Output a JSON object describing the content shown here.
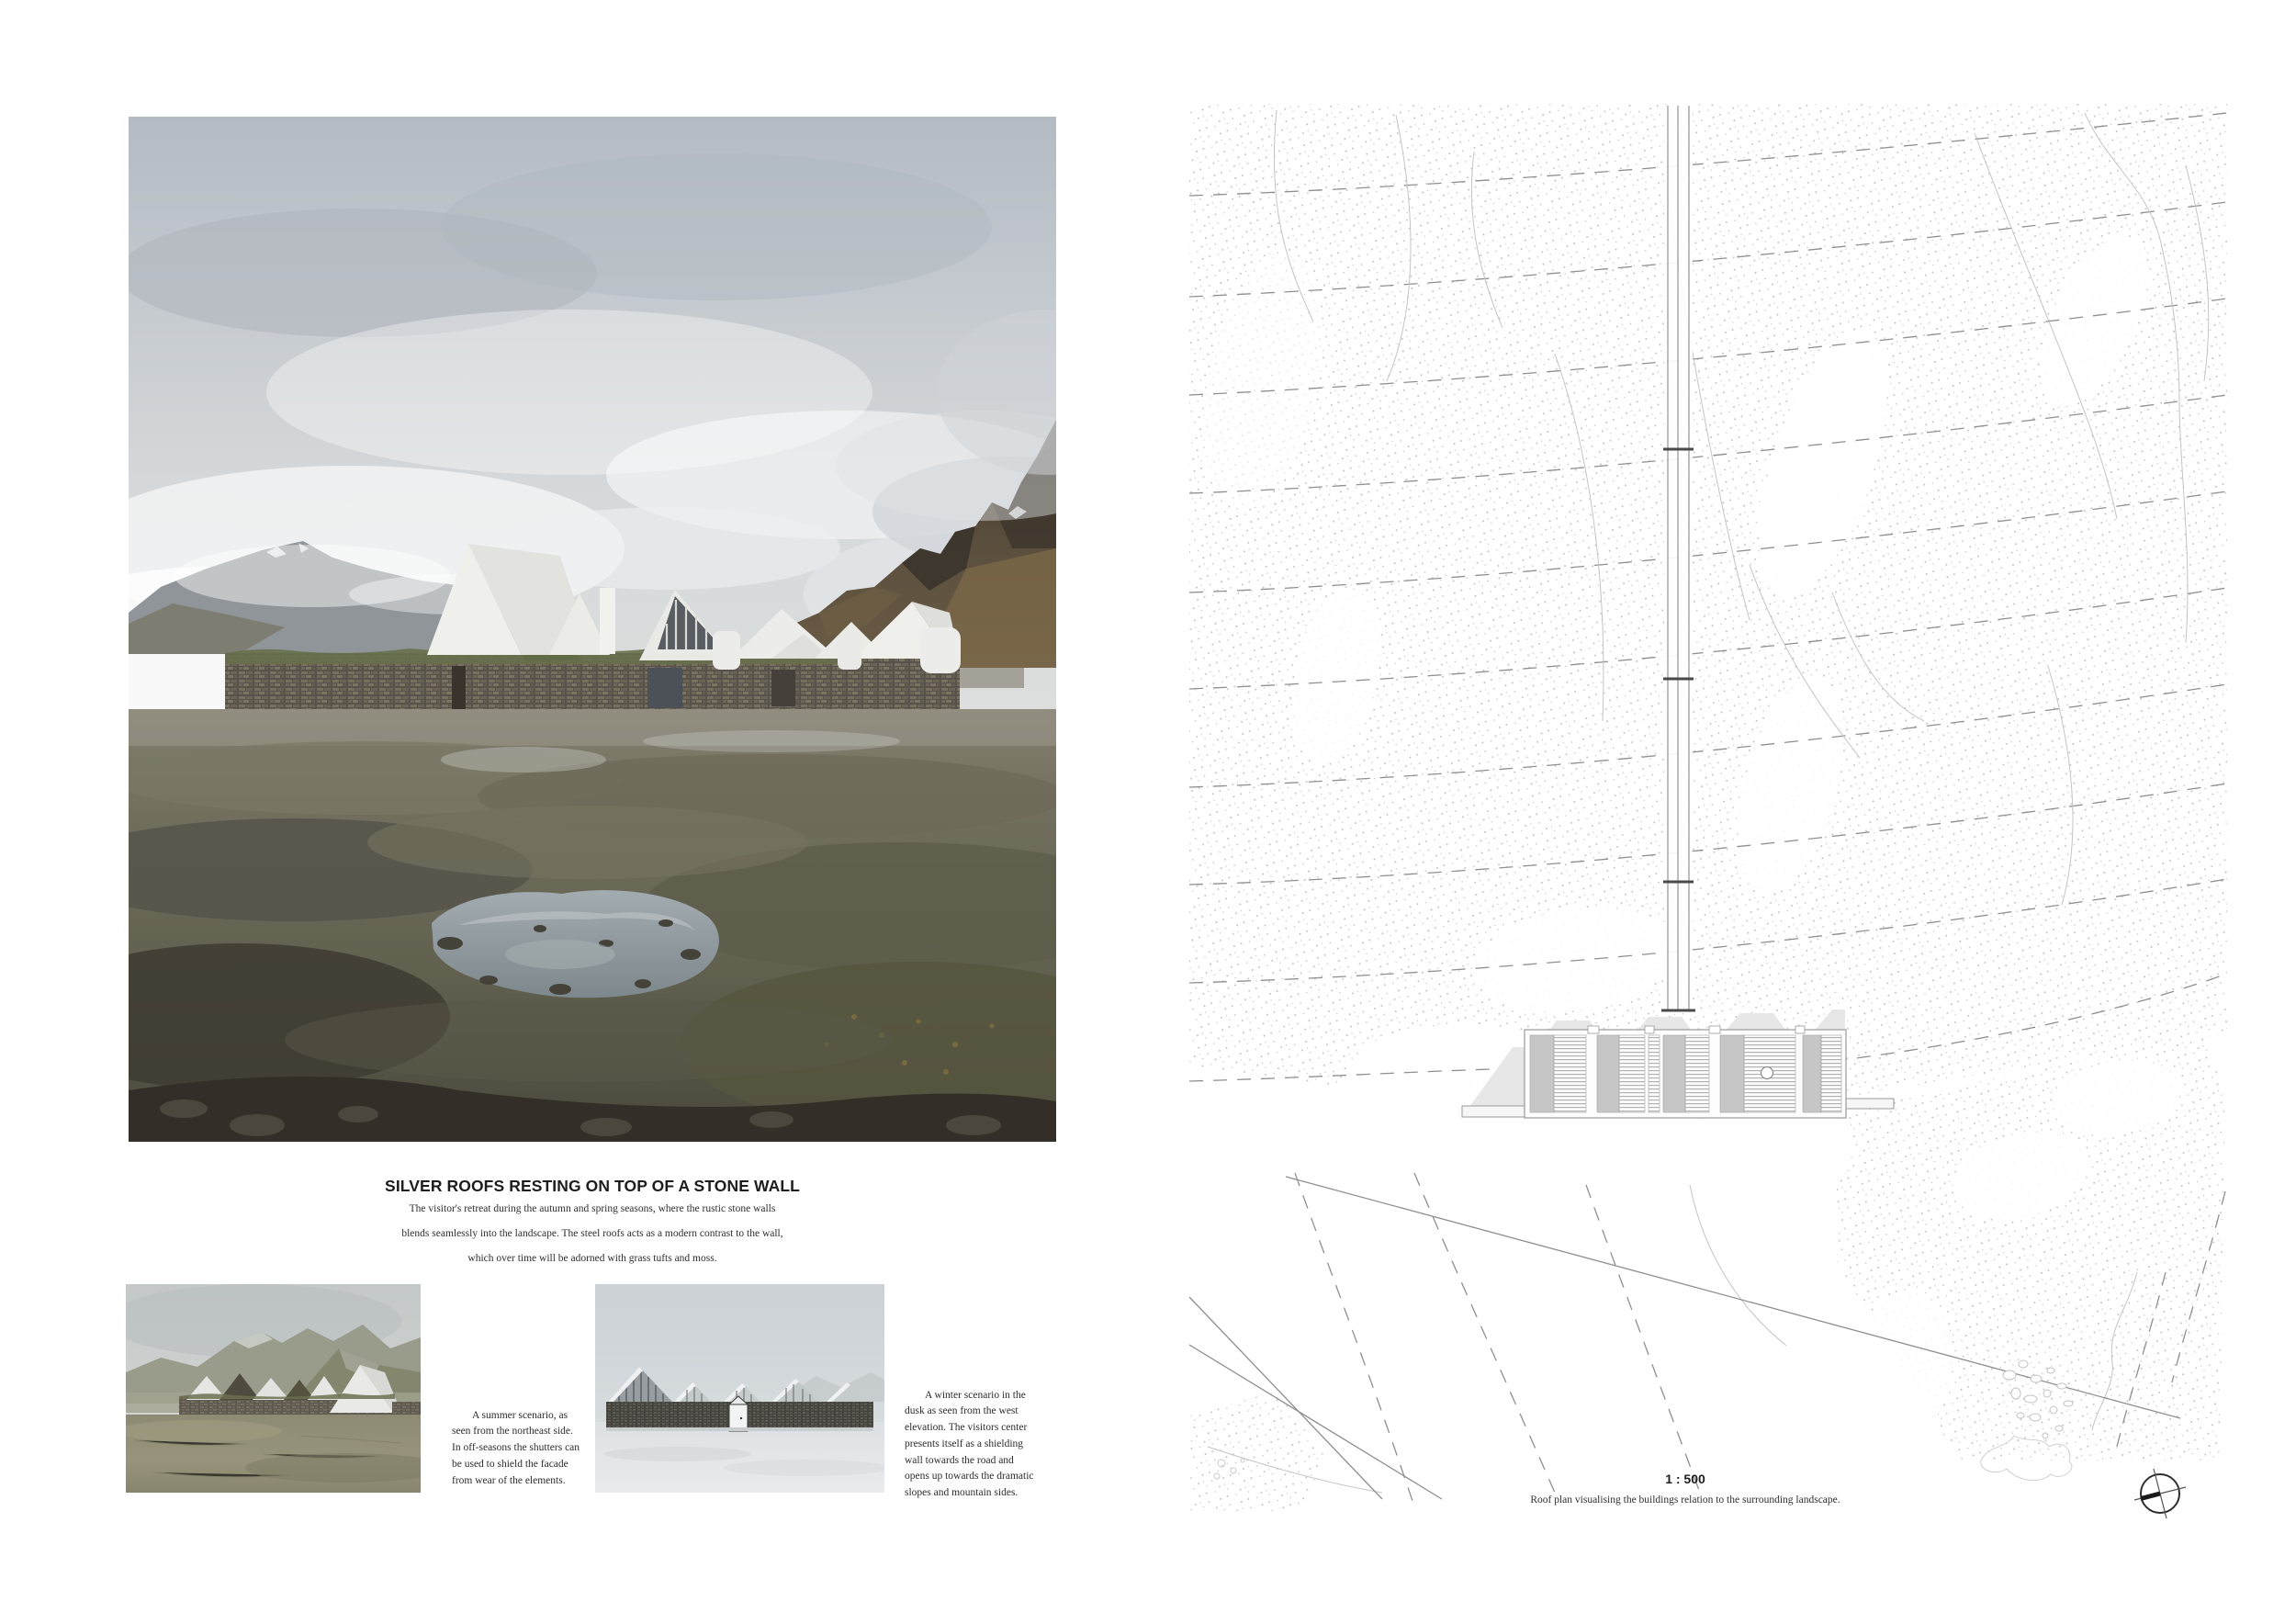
{
  "page": {
    "main": {
      "title": "SILVER ROOFS RESTING ON TOP OF A STONE WALL",
      "body_lines": [
        "The visitor's retreat during the autumn and spring seasons, where the rustic stone walls",
        "blends seamlessly into the landscape. The steel roofs acts as a modern contrast to the wall,",
        "which over time will be adorned with grass tufts and moss."
      ]
    },
    "thumbnails": {
      "summer": {
        "caption": "A summer scenario, as seen from the northeast side. In off-seasons the shutters can be used to shield the facade from wear of the elements."
      },
      "winter": {
        "caption": "A winter scenario in the dusk as seen from the west elevation. The visitors center presents itself as a shielding wall towards the road and opens up towards the dramatic slopes and mountain sides."
      }
    },
    "plan": {
      "scale_label": "1 : 500",
      "caption": "Roof plan visualising the buildings relation to the surrounding landscape."
    },
    "colors": {
      "sky_top": "#b4bbc3",
      "sky_low": "#dadcdc",
      "mountain_dark": "#4a4238",
      "mountain_ochre": "#7d6a49",
      "roof_white": "#ececea",
      "stone_wall": "#6e685c",
      "moor": "#6f6d5d",
      "pond": "#97a1a5",
      "plan_line": "#8f8f8f",
      "stipple": "#a5a5a5"
    }
  }
}
